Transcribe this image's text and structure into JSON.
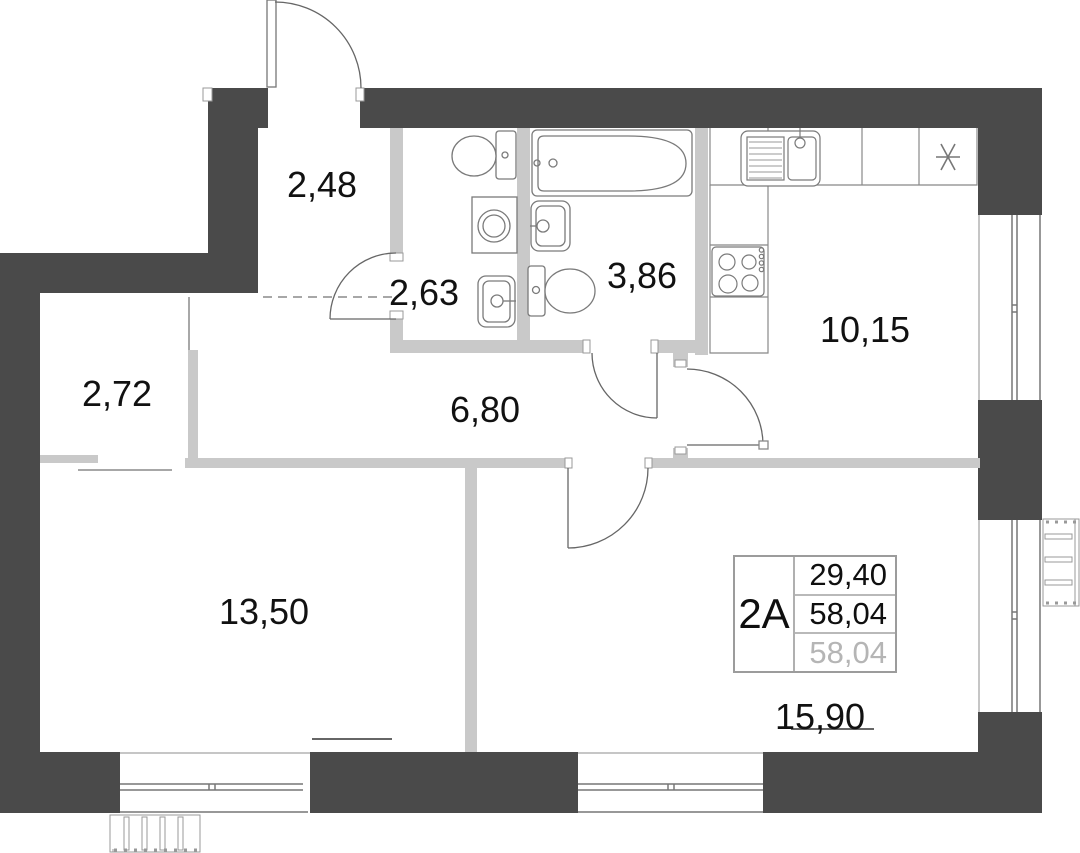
{
  "unit_table": {
    "unit_name": "2А",
    "values": [
      {
        "value": "29,40",
        "muted": false
      },
      {
        "value": "58,04",
        "muted": false
      },
      {
        "value": "58,04",
        "muted": true
      }
    ]
  },
  "rooms": [
    {
      "name": "hallway",
      "area": "2,48"
    },
    {
      "name": "wc",
      "area": "2,63"
    },
    {
      "name": "bathroom",
      "area": "3,86"
    },
    {
      "name": "kitchen",
      "area": "10,15"
    },
    {
      "name": "wardrobe",
      "area": "2,72"
    },
    {
      "name": "corridor",
      "area": "6,80"
    },
    {
      "name": "bedroom",
      "area": "13,50"
    },
    {
      "name": "living-room",
      "area": "15,90"
    }
  ],
  "icons": [
    "toilet-icon",
    "washing-machine-icon",
    "sink-icon",
    "bathtub-icon",
    "kitchen-sink-icon",
    "stove-icon",
    "cooker-asterisk-icon",
    "radiator-icon",
    "ac-basket-icon",
    "window-icon",
    "door-arc-icon"
  ],
  "colors": {
    "exterior_wall": "#4a4a4a",
    "interior_wall": "#c9c9c9",
    "outline": "#777777",
    "text": "#111111",
    "muted_text": "#b5b5b5",
    "table_border": "#9c9c9c",
    "background": "#ffffff"
  }
}
